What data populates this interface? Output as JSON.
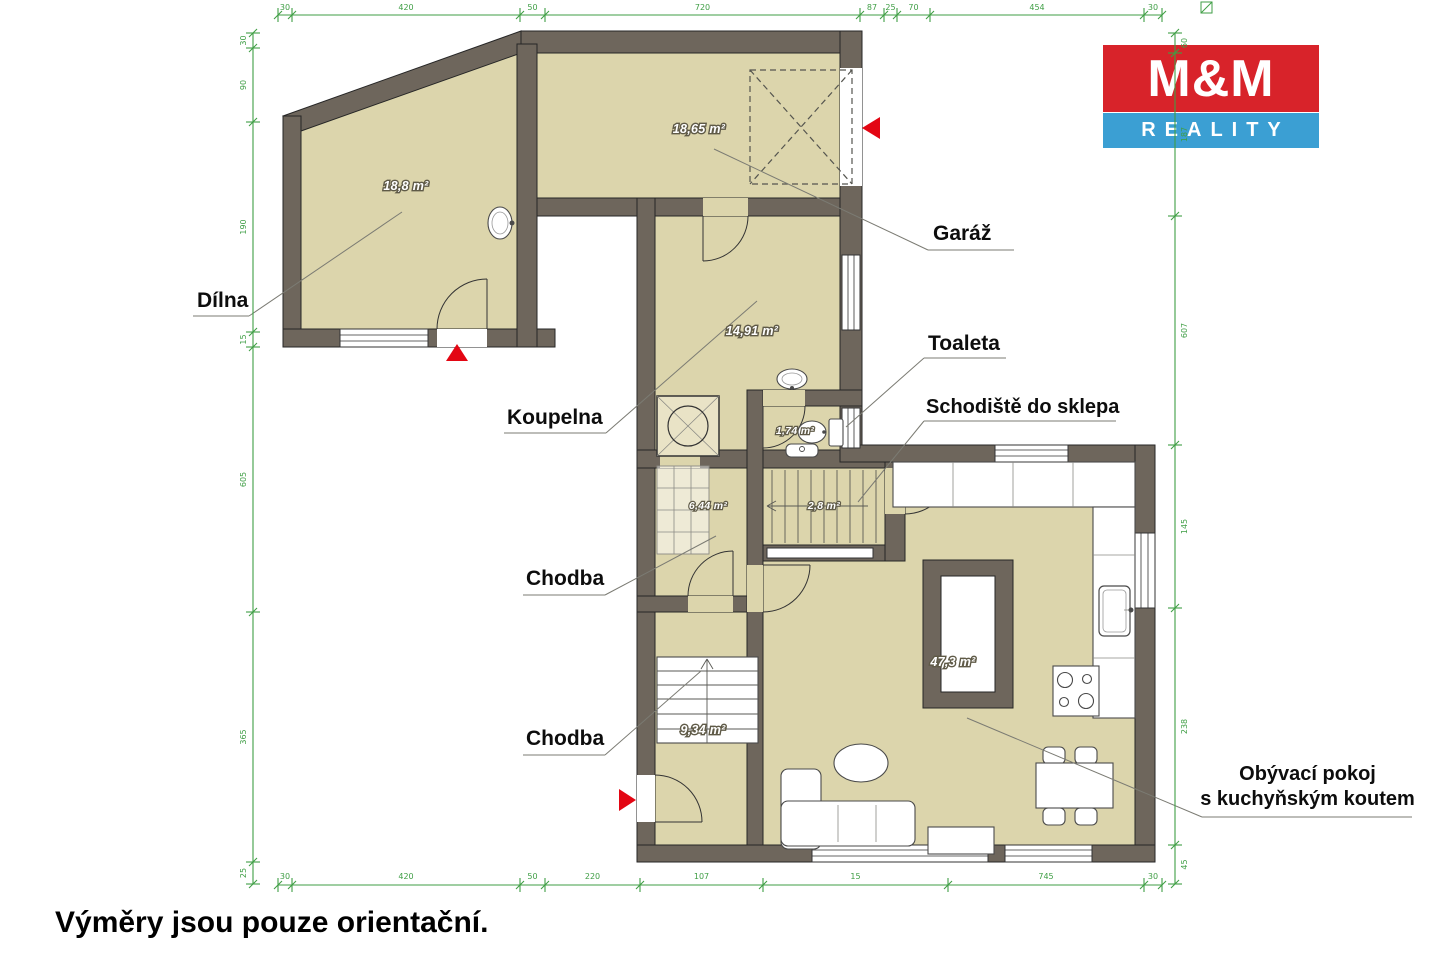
{
  "logo": {
    "line1": "M&M",
    "line2": "REALITY",
    "red": "#d8232a",
    "blue": "#3b9fd3"
  },
  "footer": {
    "disclaimer": "Výměry jsou pouze orientační."
  },
  "plan": {
    "colors": {
      "wall": "#6e665c",
      "room": "#dcd5ac",
      "dimension": "#3f9e45",
      "entrance_arrow": "#e30613"
    },
    "rooms": [
      {
        "id": "dilna",
        "label": "Dílna",
        "area": "18,8 m²"
      },
      {
        "id": "garaz",
        "label": "Garáž",
        "area": "18,65 m²"
      },
      {
        "id": "koupelna",
        "label": "Koupelna",
        "area": "14,91 m²"
      },
      {
        "id": "toaleta",
        "label": "Toaleta",
        "area": "1,74 m²"
      },
      {
        "id": "schodiste-do-sklepa",
        "label": "Schodiště do sklepa",
        "area": "2,8 m²"
      },
      {
        "id": "chodba-horni",
        "label": "Chodba",
        "area": "6,44 m²"
      },
      {
        "id": "chodba-dolni",
        "label": "Chodba",
        "area": "9,34 m²"
      },
      {
        "id": "obyvaci-pokoj",
        "label_line1": "Obývací pokoj",
        "label_line2": "s kuchyňským koutem",
        "area": "47,3 m²"
      }
    ],
    "dimensions": {
      "top": [
        "30",
        "420",
        "50",
        "720",
        "87",
        "25",
        "70",
        "454",
        "30"
      ],
      "bottom": [
        "30",
        "420",
        "50",
        "220",
        "107",
        "15",
        "745",
        "30"
      ],
      "left": [
        "30",
        "90",
        "190",
        "15",
        "605",
        "365",
        "25"
      ],
      "right": [
        "60",
        "187",
        "607",
        "145",
        "238",
        "45"
      ]
    }
  }
}
